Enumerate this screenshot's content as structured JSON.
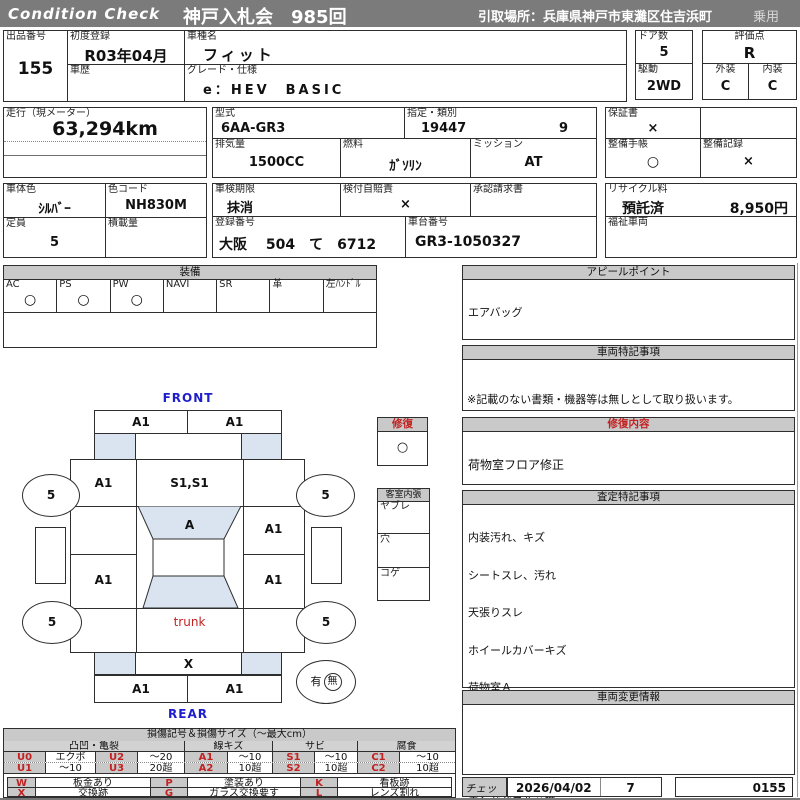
{
  "header": {
    "brand": "Condition  Check",
    "auction": "神戸入札会　985回",
    "pickup": "引取場所：兵庫県神戸市東灘区住吉浜町",
    "vehicle_class": "乗用"
  },
  "info": {
    "exhibit_no_label": "出品番号",
    "exhibit_no": "155",
    "first_reg_label": "初度登録",
    "first_reg": "R03年04月",
    "history_label": "車歴",
    "model_name_label": "車種名",
    "model_name": "フィット",
    "grade_label": "グレード・仕様",
    "grade": "e：HEV　BASIC",
    "doors_label": "ドア数",
    "doors": "5",
    "drive_label": "駆動",
    "drive": "2WD",
    "rating_label": "評価点",
    "rating": "R",
    "exterior_label": "外装",
    "exterior": "C",
    "interior_label": "内装",
    "interior": "C",
    "mileage_label": "走行（現メーター）",
    "mileage": "63,294km",
    "model_code_label": "型式",
    "model_code": "6AA-GR3",
    "class_label": "指定・類別",
    "class_no1": "19447",
    "class_no2": "9",
    "displacement_label": "排気量",
    "displacement": "1500CC",
    "fuel_label": "燃料",
    "fuel": "ｶﾞｿﾘﾝ",
    "transmission_label": "ミッション",
    "transmission": "AT",
    "warranty_label": "保証書",
    "warranty": "×",
    "maintenance_book_label": "整備手帳",
    "maintenance_book": "○",
    "maintenance_record_label": "整備記録",
    "maintenance_record": "×",
    "body_color_label": "車体色",
    "body_color": "ｼﾙﾊﾞｰ",
    "color_code_label": "色コード",
    "color_code": "NH830M",
    "capacity_label": "定員",
    "capacity": "5",
    "load_label": "積載量",
    "inspection_label": "車検期限",
    "inspection": "抹消",
    "insurance_label": "検付自賠責",
    "insurance": "×",
    "approval_label": "承認請求書",
    "recycle_label": "リサイクル料",
    "recycle_status": "預託済",
    "recycle_fee": "8,950円",
    "reg_no_label": "登録番号",
    "reg_no": "大阪　 504　て　6712",
    "chassis_no_label": "車台番号",
    "chassis_no": "GR3-1050327",
    "welfare_label": "福祉車両"
  },
  "equipment": {
    "title": "装備",
    "cols": [
      {
        "label": "AC",
        "mark": "○"
      },
      {
        "label": "PS",
        "mark": "○"
      },
      {
        "label": "PW",
        "mark": "○"
      },
      {
        "label": "NAVI",
        "mark": ""
      },
      {
        "label": "SR",
        "mark": ""
      },
      {
        "label": "革",
        "mark": ""
      },
      {
        "label": "左ﾊﾝﾄﾞﾙ",
        "mark": ""
      }
    ]
  },
  "diagram": {
    "front_label": "FRONT",
    "rear_label": "REAR",
    "marks": {
      "front_bumper_left": "A1",
      "front_bumper_right": "A1",
      "left_front_panel": "A1",
      "windshield": "S1,S1",
      "roof": "A",
      "right_front_door": "A1",
      "left_rear_door": "A1",
      "right_rear_door": "A1",
      "trunk": "trunk",
      "rear_panel": "X",
      "rear_bumper_left": "A1",
      "rear_bumper_right": "A1"
    },
    "wheel_left_front": "5",
    "wheel_right_front": "5",
    "wheel_left_rear": "5",
    "wheel_right_rear": "5",
    "spare_yes": "有",
    "spare_no": "無",
    "repair_box": {
      "title": "修復",
      "mark": "○"
    },
    "cabin_box": {
      "title": "客室内張",
      "row1": "ヤブレ",
      "row2": "穴",
      "row3": "コゲ"
    }
  },
  "panels": {
    "appeal": {
      "title": "アピールポイント",
      "items": [
        "エアバッグ",
        "ABS",
        "プッシュスタート",
        "ETC"
      ]
    },
    "vehicle_notes": {
      "title": "車両特記事項",
      "note": "※記載のない書類・機器等は無しとして取り扱います。"
    },
    "repair_details": {
      "title": "修復内容",
      "items": [
        "荷物室フロア修正"
      ]
    },
    "assessment": {
      "title": "査定特記事項",
      "items": [
        "内装汚れ、キズ",
        "シートスレ、汚れ",
        "天張りスレ",
        "ホイールカバーキズ",
        "荷物室Ａ",
        "パンク修理キット有",
        "下回りこすり",
        "エンドパネル交換"
      ]
    },
    "change_info": {
      "title": "車両変更情報"
    },
    "check": {
      "label": "チェック",
      "date": "2026/04/02",
      "inspector": "7",
      "sheet_no": "0155"
    }
  },
  "legend": {
    "title": "損傷記号＆損傷サイズ（〜最大cm）",
    "groups": [
      "凸凹・亀裂",
      "線キズ",
      "サビ",
      "腐食"
    ],
    "row1": {
      "c1": "U0",
      "v1": "エクボ",
      "c2": "U2",
      "v2": "〜20",
      "c3": "A1",
      "v3": "〜10",
      "c4": "S1",
      "v4": "〜10",
      "c5": "C1",
      "v5": "〜10"
    },
    "row2": {
      "c1": "U1",
      "v1": "〜10",
      "c2": "U3",
      "v2": "20超",
      "c3": "A2",
      "v3": "10超",
      "c4": "S2",
      "v4": "10超",
      "c5": "C2",
      "v5": "10超"
    },
    "row3": {
      "c1": "W",
      "v1": "板金あり",
      "c2": "P",
      "v2": "塗装あり",
      "c3": "K",
      "v3": "看板跡"
    },
    "row4": {
      "c1": "X",
      "v1": "交換跡",
      "c2": "G",
      "v2": "ガラス交換要す",
      "c3": "L",
      "v3": "レンズ割れ"
    }
  }
}
